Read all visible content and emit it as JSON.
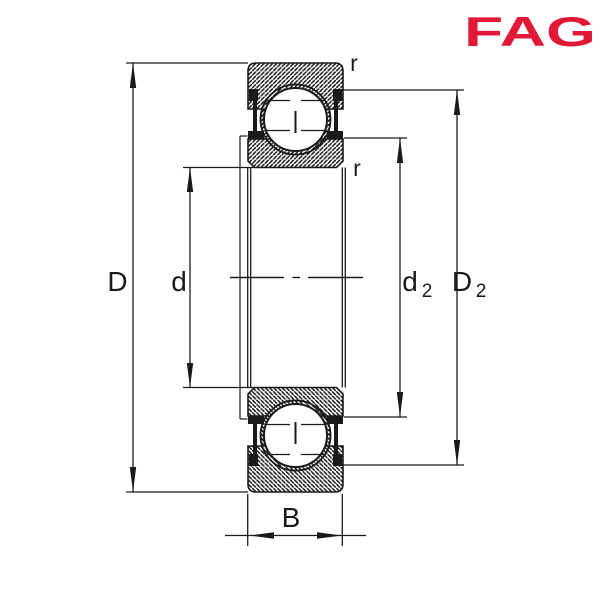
{
  "logo": {
    "text": "FAG",
    "color": "#E11937"
  },
  "drawing": {
    "type": "bearing cross-section diagram",
    "subject": "Shielded deep groove ball bearing, dimensioned sectional drawing",
    "line_color": "#1a1a1a",
    "background_color": "#ffffff",
    "labels": {
      "outer_diameter": "D",
      "bore_diameter": "d",
      "d2_base": "d",
      "d2_sub": "2",
      "D2_base": "D",
      "D2_sub": "2",
      "chamfer_top": "r",
      "chamfer_inner": "r",
      "width": "B"
    }
  }
}
